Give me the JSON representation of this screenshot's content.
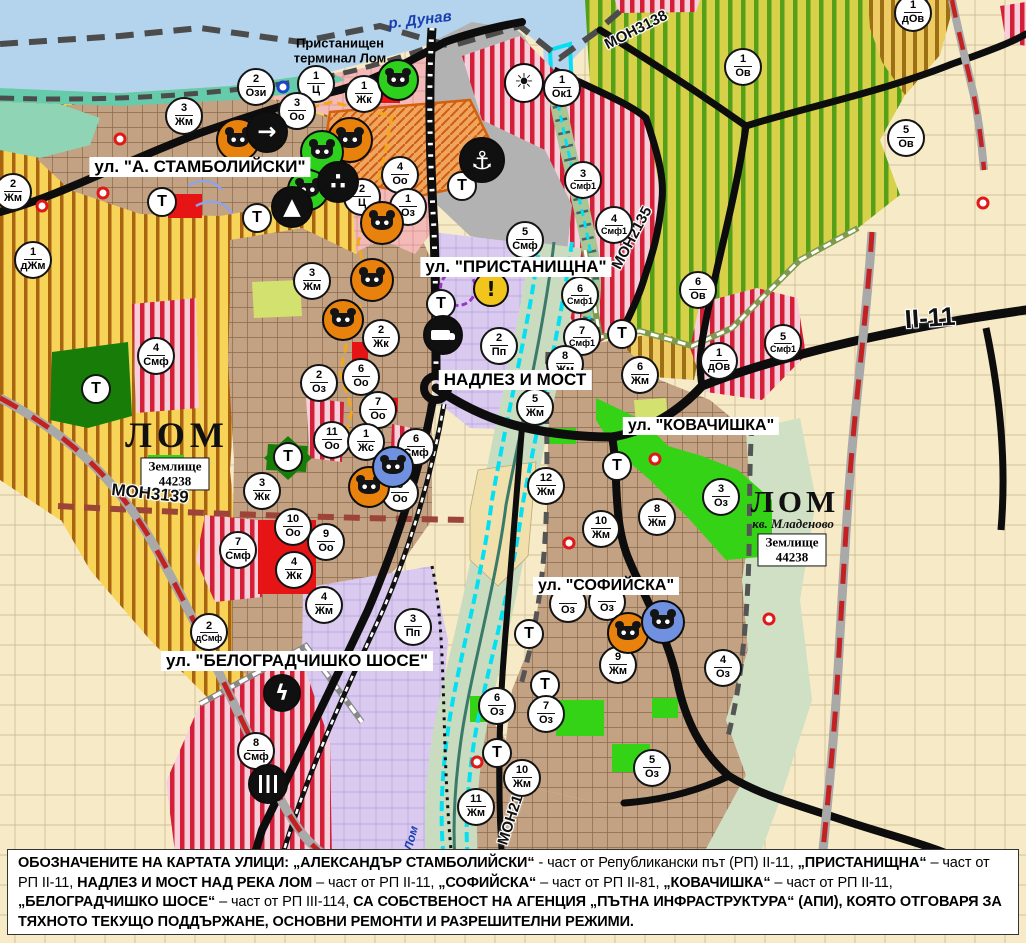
{
  "map": {
    "labels": {
      "river_danube": "р. Дунав",
      "river_lom": "Лом",
      "port_terminal_lines": [
        "Пристанищен",
        "терминал Лом"
      ],
      "transport_badge": "Т"
    },
    "street_labels": [
      {
        "text": "ул. \"А. СТАМБОЛИЙСКИ\"",
        "x": 200,
        "y": 167,
        "fs": 17
      },
      {
        "text": "ул. \"ПРИСТАНИЩНА\"",
        "x": 516,
        "y": 267,
        "fs": 17
      },
      {
        "text": "НАДЛЕЗ И МОСТ",
        "x": 515,
        "y": 380,
        "fs": 17
      },
      {
        "text": "ул. \"КОВАЧИШКА\"",
        "x": 701,
        "y": 426,
        "fs": 16
      },
      {
        "text": "ул. \"СОФИЙСКА\"",
        "x": 606,
        "y": 586,
        "fs": 16
      },
      {
        "text": "ул. \"БЕЛОГРАДЧИШКО ШОСЕ\"",
        "x": 297,
        "y": 661,
        "fs": 17
      }
    ],
    "road_labels": [
      {
        "text": "МОН3139",
        "x": 150,
        "y": 494,
        "rot": 6,
        "fs": 17
      },
      {
        "text": "МОН3138",
        "x": 636,
        "y": 30,
        "rot": -27,
        "fs": 15
      },
      {
        "text": "МОН2135",
        "x": 632,
        "y": 238,
        "rot": -62,
        "fs": 15
      },
      {
        "text": "МОН2136",
        "x": 513,
        "y": 812,
        "rot": -72,
        "fs": 15
      },
      {
        "text": "II-11",
        "x": 930,
        "y": 318,
        "rot": -4,
        "fs": 26
      }
    ],
    "city_labels": [
      {
        "text": "ЛОМ",
        "x": 177,
        "y": 435,
        "fs": 36,
        "ls": 5
      },
      {
        "text": "ЛОМ",
        "x": 795,
        "y": 502,
        "fs": 31,
        "ls": 4
      }
    ],
    "district_label": {
      "text": "кв. Младеново",
      "x": 793,
      "y": 524,
      "fs": 13
    },
    "landplot_boxes": [
      {
        "line1": "Землище",
        "line2": "44238",
        "x": 175,
        "y": 474
      },
      {
        "line1": "Землище",
        "line2": "44238",
        "x": 792,
        "y": 550
      }
    ],
    "port_label": {
      "x": 340,
      "y": 51
    },
    "river_labels": [
      {
        "text": "р. Дунав",
        "x": 420,
        "y": 20,
        "rot": -7,
        "fs": 15
      },
      {
        "text": "Лом",
        "x": 411,
        "y": 838,
        "rot": -75,
        "fs": 12
      }
    ],
    "badges": [
      {
        "n": "2",
        "c": "Ози",
        "x": 256,
        "y": 87
      },
      {
        "n": "1",
        "c": "Ц",
        "x": 316,
        "y": 84
      },
      {
        "n": "1",
        "c": "Жк",
        "x": 364,
        "y": 94
      },
      {
        "n": "3",
        "c": "Оо",
        "x": 297,
        "y": 111
      },
      {
        "n": "1",
        "c": "Ок1",
        "x": 562,
        "y": 88
      },
      {
        "n": "3",
        "c": "Жм",
        "x": 184,
        "y": 116
      },
      {
        "n": "2",
        "c": "Жм",
        "x": 13,
        "y": 192
      },
      {
        "n": "1",
        "c": "дЖм",
        "x": 33,
        "y": 260
      },
      {
        "n": "3",
        "c": "Жм",
        "x": 312,
        "y": 281
      },
      {
        "n": "4",
        "c": "Оо",
        "x": 400,
        "y": 175
      },
      {
        "n": "2",
        "c": "Ц",
        "x": 362,
        "y": 197
      },
      {
        "n": "1",
        "c": "Оз",
        "x": 408,
        "y": 207
      },
      {
        "n": "5",
        "c": "Смф",
        "x": 525,
        "y": 240
      },
      {
        "n": "3",
        "c": "Смф1",
        "x": 583,
        "y": 180
      },
      {
        "n": "4",
        "c": "Смф1",
        "x": 614,
        "y": 225
      },
      {
        "n": "6",
        "c": "Смф1",
        "x": 580,
        "y": 295
      },
      {
        "n": "7",
        "c": "Смф1",
        "x": 582,
        "y": 337
      },
      {
        "n": "6",
        "c": "Ов",
        "x": 698,
        "y": 290
      },
      {
        "n": "1",
        "c": "Ов",
        "x": 743,
        "y": 67
      },
      {
        "n": "5",
        "c": "Ов",
        "x": 906,
        "y": 138
      },
      {
        "n": "1",
        "c": "дОв",
        "x": 913,
        "y": 13
      },
      {
        "n": "1",
        "c": "дОв",
        "x": 719,
        "y": 361
      },
      {
        "n": "5",
        "c": "Смф1",
        "x": 783,
        "y": 343
      },
      {
        "n": "2",
        "c": "Пп",
        "x": 499,
        "y": 346
      },
      {
        "n": "8",
        "c": "Жм",
        "x": 565,
        "y": 364
      },
      {
        "n": "5",
        "c": "Жм",
        "x": 535,
        "y": 407
      },
      {
        "n": "6",
        "c": "Жм",
        "x": 640,
        "y": 375
      },
      {
        "n": "12",
        "c": "Жм",
        "x": 546,
        "y": 486
      },
      {
        "n": "10",
        "c": "Жм",
        "x": 601,
        "y": 529
      },
      {
        "n": "8",
        "c": "Жм",
        "x": 657,
        "y": 517
      },
      {
        "n": "3",
        "c": "Оз",
        "x": 721,
        "y": 497
      },
      {
        "n": "2",
        "c": "Жк",
        "x": 381,
        "y": 338
      },
      {
        "n": "6",
        "c": "Оо",
        "x": 361,
        "y": 377
      },
      {
        "n": "7",
        "c": "Оо",
        "x": 378,
        "y": 410
      },
      {
        "n": "2",
        "c": "Оз",
        "x": 319,
        "y": 383
      },
      {
        "n": "11",
        "c": "Оо",
        "x": 332,
        "y": 440
      },
      {
        "n": "1",
        "c": "Жс",
        "x": 366,
        "y": 442
      },
      {
        "n": "6",
        "c": "Смф",
        "x": 416,
        "y": 447
      },
      {
        "n": "8",
        "c": "Оо",
        "x": 400,
        "y": 493
      },
      {
        "n": "3",
        "c": "Жк",
        "x": 262,
        "y": 491
      },
      {
        "n": "10",
        "c": "Оо",
        "x": 293,
        "y": 527
      },
      {
        "n": "9",
        "c": "Оо",
        "x": 326,
        "y": 542
      },
      {
        "n": "4",
        "c": "Жк",
        "x": 294,
        "y": 570
      },
      {
        "n": "7",
        "c": "Смф",
        "x": 238,
        "y": 550
      },
      {
        "n": "4",
        "c": "Жм",
        "x": 324,
        "y": 605
      },
      {
        "n": "3",
        "c": "Пп",
        "x": 413,
        "y": 627
      },
      {
        "n": "2",
        "c": "дСмф",
        "x": 209,
        "y": 632
      },
      {
        "n": "8",
        "c": "Смф",
        "x": 256,
        "y": 751
      },
      {
        "n": "4",
        "c": "Смф",
        "x": 156,
        "y": 356
      },
      {
        "n": "9",
        "c": "Жм",
        "x": 618,
        "y": 665
      },
      {
        "n": "4",
        "c": "Оз",
        "x": 723,
        "y": 668
      },
      {
        "n": "6",
        "c": "Оз",
        "x": 497,
        "y": 706
      },
      {
        "n": "7",
        "c": "Оз",
        "x": 546,
        "y": 714
      },
      {
        "n": "10",
        "c": "Жм",
        "x": 522,
        "y": 778
      },
      {
        "n": "11",
        "c": "Жм",
        "x": 476,
        "y": 807
      },
      {
        "n": "5",
        "c": "Оз",
        "x": 652,
        "y": 768
      },
      {
        "n": "",
        "c": "Оз",
        "x": 568,
        "y": 604
      },
      {
        "n": "",
        "c": "Оз",
        "x": 607,
        "y": 602
      }
    ],
    "t_badges": [
      {
        "x": 162,
        "y": 202
      },
      {
        "x": 257,
        "y": 218
      },
      {
        "x": 462,
        "y": 186
      },
      {
        "x": 441,
        "y": 304
      },
      {
        "x": 96,
        "y": 389
      },
      {
        "x": 288,
        "y": 457
      },
      {
        "x": 622,
        "y": 334
      },
      {
        "x": 617,
        "y": 466
      },
      {
        "x": 529,
        "y": 634
      },
      {
        "x": 545,
        "y": 685
      },
      {
        "x": 497,
        "y": 753
      }
    ],
    "icons": [
      {
        "name": "port-anchor-icon",
        "bg": "#101010",
        "fg": "#ffffff",
        "glyph": "⚓",
        "x": 482,
        "y": 160,
        "s": 46
      },
      {
        "name": "harbor-crane-icon",
        "bg": "#ffffff",
        "fg": "#101010",
        "glyph": "☀",
        "x": 524,
        "y": 83,
        "s": 40
      },
      {
        "name": "culture-monument-icon",
        "kind": "masks",
        "bg": "#e8820c",
        "x": 238,
        "y": 140,
        "s": 44
      },
      {
        "name": "culture-monument-icon",
        "kind": "masks",
        "bg": "#e8820c",
        "x": 350,
        "y": 140,
        "s": 46
      },
      {
        "name": "culture-monument-icon",
        "kind": "masks",
        "bg": "#e8820c",
        "x": 382,
        "y": 223,
        "s": 44
      },
      {
        "name": "culture-monument-icon",
        "kind": "masks",
        "bg": "#e8820c",
        "x": 372,
        "y": 280,
        "s": 44
      },
      {
        "name": "culture-monument-icon",
        "kind": "masks",
        "bg": "#e8820c",
        "x": 343,
        "y": 320,
        "s": 42
      },
      {
        "name": "culture-monument-icon",
        "kind": "masks",
        "bg": "#e8820c",
        "x": 369,
        "y": 487,
        "s": 42
      },
      {
        "name": "culture-monument-icon",
        "kind": "masks",
        "bg": "#e8820c",
        "x": 628,
        "y": 633,
        "s": 42
      },
      {
        "name": "culture-monument-icon-green",
        "kind": "masks",
        "bg": "#2ed01e",
        "x": 398,
        "y": 80,
        "s": 42
      },
      {
        "name": "culture-monument-icon-green",
        "kind": "masks",
        "bg": "#2ed01e",
        "x": 322,
        "y": 152,
        "s": 44
      },
      {
        "name": "culture-monument-icon-green",
        "kind": "masks",
        "bg": "#2ed01e",
        "x": 308,
        "y": 190,
        "s": 42
      },
      {
        "name": "culture-monument-icon-blue",
        "kind": "masks",
        "bg": "#7090e0",
        "x": 393,
        "y": 467,
        "s": 42
      },
      {
        "name": "culture-monument-icon-blue",
        "kind": "masks",
        "bg": "#7090e0",
        "x": 663,
        "y": 622,
        "s": 44
      },
      {
        "name": "gate-arrow-icon",
        "bg": "#101010",
        "fg": "#ffffff",
        "glyph": "→",
        "x": 267,
        "y": 132,
        "s": 42
      },
      {
        "name": "people-monument-icon",
        "bg": "#101010",
        "fg": "#ffffff",
        "glyph": "∴",
        "x": 338,
        "y": 182,
        "s": 42
      },
      {
        "name": "mound-icon",
        "bg": "#101010",
        "fg": "#ffffff",
        "glyph": "▲",
        "x": 292,
        "y": 207,
        "s": 42
      },
      {
        "name": "truck-terminal-icon",
        "kind": "truck",
        "bg": "#101010",
        "x": 443,
        "y": 335,
        "s": 40
      },
      {
        "name": "power-station-icon",
        "bg": "#101010",
        "fg": "#ffffff",
        "glyph": "ϟ",
        "x": 282,
        "y": 693,
        "s": 38
      },
      {
        "name": "railway-station-icon",
        "kind": "rails",
        "bg": "#101010",
        "x": 268,
        "y": 784,
        "s": 40
      },
      {
        "name": "warning-icon",
        "bg": "#f2c51c",
        "fg": "#101010",
        "glyph": "!",
        "x": 491,
        "y": 289,
        "s": 36
      }
    ],
    "rings": [
      {
        "x": 120,
        "y": 139,
        "color": "#e01818"
      },
      {
        "x": 103,
        "y": 193,
        "color": "#e01818"
      },
      {
        "x": 42,
        "y": 206,
        "color": "#e01818"
      },
      {
        "x": 655,
        "y": 459,
        "color": "#e01818"
      },
      {
        "x": 569,
        "y": 543,
        "color": "#e01818"
      },
      {
        "x": 477,
        "y": 762,
        "color": "#e01818"
      },
      {
        "x": 769,
        "y": 619,
        "color": "#e01818"
      },
      {
        "x": 983,
        "y": 203,
        "color": "#e01818"
      },
      {
        "x": 283,
        "y": 87,
        "color": "#1a46c8"
      }
    ],
    "heritage_ring": {
      "x": 458,
      "y": 288
    },
    "colors": {
      "water": "#b4d4ee",
      "port_gray": "#b2b2b2",
      "vineyard_stripe": "#55a018",
      "residential_yellow": "#f7d458",
      "smf_red": "#d41f38",
      "lavender": "#dacaf0",
      "urban_tan": "#c3a284",
      "cyan_river": "#04dff2",
      "road_black": "#0d0d0d",
      "boundary_red_dash": "#c32222"
    }
  },
  "caption": {
    "segments": [
      {
        "t": "ОБОЗНАЧЕНИТЕ НА КАРТАТА УЛИЦИ: „АЛЕКСАНДЪР СТАМБОЛИЙСКИ“",
        "b": true
      },
      {
        "t": " - част от Републикански път (РП) II-11, ",
        "b": false
      },
      {
        "t": "„ПРИСТАНИЩНА“",
        "b": true
      },
      {
        "t": " – част от РП II-11, ",
        "b": false
      },
      {
        "t": "НАДЛЕЗ И МОСТ НАД РЕКА ЛОМ",
        "b": true
      },
      {
        "t": " – част от РП II-11, ",
        "b": false
      },
      {
        "t": "„СОФИЙСКА“",
        "b": true
      },
      {
        "t": " – част от РП II-81, ",
        "b": false
      },
      {
        "t": "„КОВАЧИШКА“",
        "b": true
      },
      {
        "t": " – част от РП II-11, ",
        "b": false
      },
      {
        "t": "„БЕЛОГРАДЧИШКО ШОСЕ“",
        "b": true
      },
      {
        "t": " – част от РП III-114, ",
        "b": false
      },
      {
        "t": "СА СОБСТВЕНОСТ НА АГЕНЦИЯ „ПЪТНА ИНФРАСТРУКТУРА“ (АПИ), КОЯТО ОТГОВАРЯ ЗА ТЯХНОТО ТЕКУЩО ПОДДЪРЖАНЕ, ОСНОВНИ РЕМОНТИ И РАЗРЕШИТЕЛНИ РЕЖИМИ.",
        "b": true
      }
    ]
  }
}
